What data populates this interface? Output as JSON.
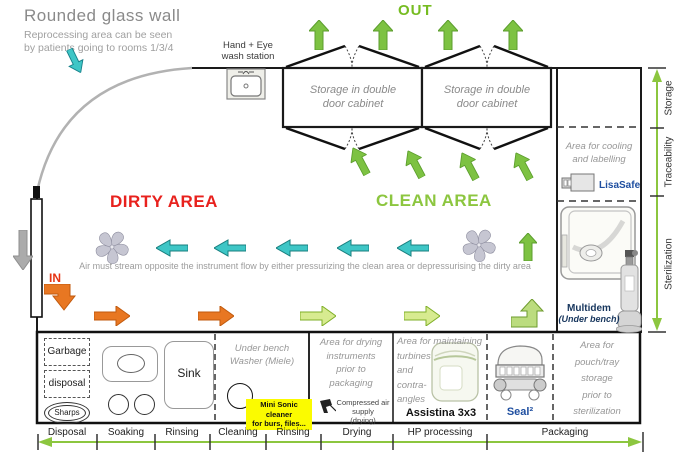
{
  "header": {
    "title": "Rounded glass wall",
    "subtitle1": "Reprocessing area can be seen",
    "subtitle2": "by patients going to rooms 1/3/4"
  },
  "wash_station": {
    "line1": "Hand + Eye",
    "line2": "wash station"
  },
  "flow": {
    "out": "OUT",
    "in": "IN"
  },
  "zones": {
    "dirty": "DIRTY AREA",
    "clean": "CLEAN AREA"
  },
  "cabinets": {
    "label_line1": "Storage in double",
    "label_line2": "door cabinet"
  },
  "air_note": "Air must stream opposite the instrument flow by either pressurizing the clean area or depressurising the dirty area",
  "right_panel": {
    "cooling_line1": "Area for cooling",
    "cooling_line2": "and labelling",
    "lisasafe": "LisaSafe",
    "multidem": "Multidem",
    "multidem_sub": "(Under bench)"
  },
  "right_axis": {
    "storage": "Storage",
    "traceability": "Traceability",
    "sterilization": "Sterilization"
  },
  "bench": {
    "garbage_line1": "Garbage",
    "garbage_line2": "disposal",
    "sharps": "Sharps",
    "sink": "Sink",
    "washer_line1": "Under bench",
    "washer_line2": "Washer (Miele)",
    "minisonic_line1": "Mini Sonic cleaner",
    "minisonic_line2": "for burs, files...",
    "drying_lines": [
      "Area for drying",
      "instruments",
      "prior to",
      "packaging"
    ],
    "compressed_line1": "Compressed air supply",
    "compressed_line2": "(drying)",
    "maintaining_lines": [
      "Area for maintaining",
      "turbines",
      "and",
      "contra-",
      "angles"
    ],
    "assistina": "Assistina 3x3",
    "seal": "Seal²",
    "pouch_lines": [
      "Area for",
      "pouch/tray",
      "storage",
      "prior to",
      "sterilization"
    ]
  },
  "bottom_axis": {
    "stages": [
      "Disposal",
      "Soaking",
      "Rinsing",
      "Cleaning",
      "Rinsing",
      "Drying",
      "HP processing",
      "Packaging"
    ]
  },
  "icons": {
    "fan": "airflow-fan-pinwheel",
    "sink": "hand-eye-wash-sink",
    "sterilizer": "bench-sterilizer",
    "bottle": "multidem-bottle",
    "assistina": "assistina-device",
    "sealer": "seal-device",
    "airgun": "compressed-air-gun"
  },
  "colors": {
    "green": "#8cc63f",
    "solid_green": "#7dc242",
    "pale_green": "#d7eb90",
    "cyan": "#3ec6c6",
    "orange": "#e87722",
    "red": "#e8211d",
    "blue": "#1f4fa0",
    "gray_text": "#979797",
    "yellow": "#fbfb00"
  }
}
